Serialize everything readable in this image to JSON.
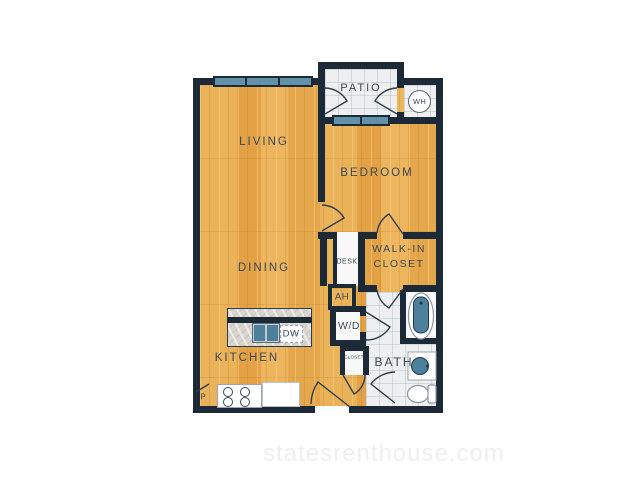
{
  "watermark": {
    "text": "statesrenthouse.com"
  },
  "rooms": {
    "living": {
      "label": "LIVING"
    },
    "bedroom": {
      "label": "BEDROOM"
    },
    "dining": {
      "label": "DINING"
    },
    "kitchen": {
      "label": "KITCHEN"
    },
    "patio": {
      "label": "PATIO"
    },
    "bath": {
      "label": "BATH"
    },
    "walk_in_closet": {
      "label_line1": "WALK-IN",
      "label_line2": "CLOSET"
    },
    "desk": {
      "label": "DESK"
    },
    "closet": {
      "label": "CLOSET"
    }
  },
  "fixtures": {
    "water_heater": {
      "label": "WH"
    },
    "air_handler": {
      "label": "AH"
    },
    "washer_dryer": {
      "label": "W/D"
    },
    "dishwasher": {
      "label": "DW"
    },
    "pantry": {
      "label": "P"
    }
  },
  "colors": {
    "wall": "#1c2a38",
    "wood_floor": "#e8a94d",
    "tile_floor": "#edeff0",
    "window": "#6292a9",
    "fixture_blue": "#4d809b",
    "label_text": "#3b4956",
    "watermark_text": "#efefef"
  }
}
